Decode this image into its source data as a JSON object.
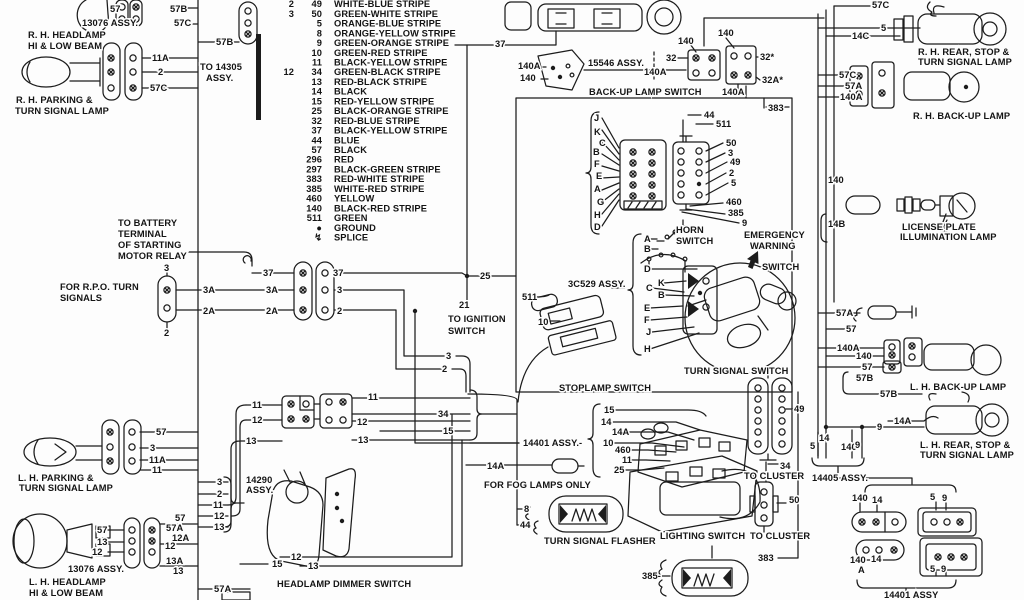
{
  "page": {
    "background": "#fdfdfd",
    "ink": "#1c1c1c"
  },
  "legend": {
    "rows": [
      {
        "a": "2",
        "b": "49",
        "name": "WHITE-BLUE STRIPE"
      },
      {
        "a": "3",
        "b": "50",
        "name": "GREEN-WHITE STRIPE"
      },
      {
        "b": "5",
        "name": "ORANGE-BLUE STRIPE"
      },
      {
        "b": "8",
        "name": "ORANGE-YELLOW STRIPE"
      },
      {
        "b": "9",
        "name": "GREEN-ORANGE STRIPE"
      },
      {
        "b": "10",
        "name": "GREEN-RED STRIPE"
      },
      {
        "b": "11",
        "name": "BLACK-YELLOW STRIPE"
      },
      {
        "a": "12",
        "b": "34",
        "name": "GREEN-BLACK STRIPE"
      },
      {
        "b": "13",
        "name": "RED-BLACK STRIPE"
      },
      {
        "b": "14",
        "name": "BLACK"
      },
      {
        "b": "15",
        "name": "RED-YELLOW STRIPE"
      },
      {
        "b": "25",
        "name": "BLACK-ORANGE STRIPE"
      },
      {
        "b": "32",
        "name": "RED-BLUE STRIPE"
      },
      {
        "b": "37",
        "name": "BLACK-YELLOW STRIPE"
      },
      {
        "b": "44",
        "name": "BLUE"
      },
      {
        "b": "57",
        "name": "BLACK"
      },
      {
        "b": "296",
        "name": "RED"
      },
      {
        "b": "297",
        "name": "BLACK-GREEN STRIPE"
      },
      {
        "b": "383",
        "name": "RED-WHITE STRIPE"
      },
      {
        "b": "385",
        "name": "WHITE-RED STRIPE"
      },
      {
        "b": "460",
        "name": "YELLOW"
      },
      {
        "b": "140",
        "name": "BLACK-RED STRIPE"
      },
      {
        "b": "511",
        "name": "GREEN"
      },
      {
        "b": "●",
        "name": "GROUND"
      },
      {
        "b": "↯",
        "name": "SPLICE"
      }
    ]
  },
  "labels": [
    {
      "t": "57",
      "x": 110,
      "y": 12
    },
    {
      "t": "13076 ASSY.",
      "x": 82,
      "y": 26,
      "n": "assembly-label"
    },
    {
      "t": "57B",
      "x": 170,
      "y": 12
    },
    {
      "t": "57C",
      "x": 174,
      "y": 26
    },
    {
      "t": "R. H. HEADLAMP",
      "x": 28,
      "y": 38,
      "n": "component-label"
    },
    {
      "t": "HI & LOW BEAM",
      "x": 28,
      "y": 49,
      "n": "component-label"
    },
    {
      "t": "57B",
      "x": 216,
      "y": 45
    },
    {
      "t": "TO 14305",
      "x": 200,
      "y": 70,
      "n": "note-label"
    },
    {
      "t": "ASSY.",
      "x": 206,
      "y": 81,
      "n": "note-label"
    },
    {
      "t": "11A",
      "x": 152,
      "y": 61
    },
    {
      "t": "2",
      "x": 158,
      "y": 75
    },
    {
      "t": "57C",
      "x": 150,
      "y": 91
    },
    {
      "t": "R. H. PARKING &",
      "x": 16,
      "y": 103,
      "n": "component-label"
    },
    {
      "t": "TURN SIGNAL LAMP",
      "x": 15,
      "y": 114,
      "n": "component-label"
    },
    {
      "t": "TO BATTERY",
      "x": 118,
      "y": 226,
      "n": "note-label"
    },
    {
      "t": "TERMINAL",
      "x": 118,
      "y": 237,
      "n": "note-label"
    },
    {
      "t": "OF STARTING",
      "x": 118,
      "y": 248,
      "n": "note-label"
    },
    {
      "t": "MOTOR RELAY",
      "x": 118,
      "y": 259,
      "n": "note-label"
    },
    {
      "t": "3",
      "x": 164,
      "y": 271
    },
    {
      "t": "FOR R.P.O. TURN",
      "x": 60,
      "y": 290,
      "n": "note-label"
    },
    {
      "t": "SIGNALS",
      "x": 60,
      "y": 301,
      "n": "note-label"
    },
    {
      "t": "2",
      "x": 164,
      "y": 336
    },
    {
      "t": "37",
      "x": 263,
      "y": 276
    },
    {
      "t": "3A",
      "x": 203,
      "y": 293
    },
    {
      "t": "2A",
      "x": 203,
      "y": 314
    },
    {
      "t": "37",
      "x": 333,
      "y": 276
    },
    {
      "t": "3A",
      "x": 266,
      "y": 293
    },
    {
      "t": "2A",
      "x": 266,
      "y": 314
    },
    {
      "t": "3",
      "x": 337,
      "y": 293
    },
    {
      "t": "2",
      "x": 337,
      "y": 314
    },
    {
      "t": "25",
      "x": 480,
      "y": 279
    },
    {
      "t": "21",
      "x": 459,
      "y": 308
    },
    {
      "t": "TO IGNITION",
      "x": 448,
      "y": 322,
      "n": "note-label"
    },
    {
      "t": "SWITCH",
      "x": 448,
      "y": 334,
      "n": "note-label"
    },
    {
      "t": "3",
      "x": 446,
      "y": 359
    },
    {
      "t": "2",
      "x": 442,
      "y": 372
    },
    {
      "t": "511",
      "x": 522,
      "y": 300
    },
    {
      "t": "10",
      "x": 538,
      "y": 325
    },
    {
      "t": "3C529 ASSY.",
      "x": 568,
      "y": 287,
      "n": "assembly-label"
    },
    {
      "t": "STOPLAMP SWITCH",
      "x": 559,
      "y": 391,
      "n": "component-label"
    },
    {
      "t": "J",
      "x": 594,
      "y": 121
    },
    {
      "t": "K",
      "x": 594,
      "y": 135
    },
    {
      "t": "C",
      "x": 599,
      "y": 146
    },
    {
      "t": "B",
      "x": 593,
      "y": 155
    },
    {
      "t": "F",
      "x": 594,
      "y": 167
    },
    {
      "t": "E",
      "x": 596,
      "y": 179
    },
    {
      "t": "A",
      "x": 594,
      "y": 192
    },
    {
      "t": "G",
      "x": 597,
      "y": 205
    },
    {
      "t": "H",
      "x": 594,
      "y": 218
    },
    {
      "t": "D",
      "x": 594,
      "y": 230
    },
    {
      "t": "44",
      "x": 704,
      "y": 118
    },
    {
      "t": "511",
      "x": 716,
      "y": 127
    },
    {
      "t": "50",
      "x": 726,
      "y": 146
    },
    {
      "t": "3",
      "x": 728,
      "y": 156
    },
    {
      "t": "49",
      "x": 730,
      "y": 165
    },
    {
      "t": "2",
      "x": 729,
      "y": 176
    },
    {
      "t": "5",
      "x": 731,
      "y": 186
    },
    {
      "t": "460",
      "x": 726,
      "y": 205
    },
    {
      "t": "385",
      "x": 728,
      "y": 216
    },
    {
      "t": "9",
      "x": 742,
      "y": 226
    },
    {
      "t": "37",
      "x": 495,
      "y": 47
    },
    {
      "t": "140",
      "x": 678,
      "y": 44
    },
    {
      "t": "140",
      "x": 718,
      "y": 36
    },
    {
      "t": "140A",
      "x": 518,
      "y": 69
    },
    {
      "t": "15546 ASSY.",
      "x": 588,
      "y": 66,
      "n": "assembly-label"
    },
    {
      "t": "140A",
      "x": 644,
      "y": 75
    },
    {
      "t": "32",
      "x": 666,
      "y": 61
    },
    {
      "t": "140",
      "x": 520,
      "y": 81
    },
    {
      "t": "32*",
      "x": 760,
      "y": 60
    },
    {
      "t": "32A*",
      "x": 762,
      "y": 83
    },
    {
      "t": "140A",
      "x": 722,
      "y": 95
    },
    {
      "t": "BACK-UP LAMP SWITCH",
      "x": 589,
      "y": 95,
      "n": "component-label"
    },
    {
      "t": "383",
      "x": 768,
      "y": 111
    },
    {
      "t": "A",
      "x": 644,
      "y": 242
    },
    {
      "t": "B",
      "x": 644,
      "y": 252
    },
    {
      "t": "HORN",
      "x": 676,
      "y": 233,
      "n": "component-label"
    },
    {
      "t": "SWITCH",
      "x": 676,
      "y": 244,
      "n": "component-label"
    },
    {
      "t": "EMERGENCY",
      "x": 744,
      "y": 238,
      "n": "component-label"
    },
    {
      "t": "WARNING",
      "x": 750,
      "y": 249,
      "n": "component-label"
    },
    {
      "t": "SWITCH",
      "x": 762,
      "y": 270,
      "n": "component-label"
    },
    {
      "t": "D",
      "x": 644,
      "y": 272
    },
    {
      "t": "K",
      "x": 658,
      "y": 286
    },
    {
      "t": "C",
      "x": 646,
      "y": 291
    },
    {
      "t": "B",
      "x": 658,
      "y": 298
    },
    {
      "t": "E",
      "x": 644,
      "y": 311
    },
    {
      "t": "F",
      "x": 644,
      "y": 323
    },
    {
      "t": "J",
      "x": 646,
      "y": 335
    },
    {
      "t": "H",
      "x": 644,
      "y": 352
    },
    {
      "t": "TURN SIGNAL SWITCH",
      "x": 684,
      "y": 374,
      "n": "component-label"
    },
    {
      "t": "49",
      "x": 794,
      "y": 412
    },
    {
      "t": "34",
      "x": 780,
      "y": 469
    },
    {
      "t": "TO CLUSTER",
      "x": 744,
      "y": 479,
      "n": "note-label"
    },
    {
      "t": "50",
      "x": 789,
      "y": 503
    },
    {
      "t": "TO CLUSTER",
      "x": 750,
      "y": 539,
      "n": "note-label"
    },
    {
      "t": "383",
      "x": 758,
      "y": 561
    },
    {
      "t": "385-",
      "x": 642,
      "y": 579
    },
    {
      "t": "57C",
      "x": 872,
      "y": 8
    },
    {
      "t": "5",
      "x": 881,
      "y": 31
    },
    {
      "t": "14C",
      "x": 852,
      "y": 39
    },
    {
      "t": "R. H. REAR, STOP &",
      "x": 918,
      "y": 55,
      "n": "component-label"
    },
    {
      "t": "TURN SIGNAL LAMP",
      "x": 918,
      "y": 65,
      "n": "component-label"
    },
    {
      "t": "57C",
      "x": 839,
      "y": 78
    },
    {
      "t": "57A",
      "x": 845,
      "y": 89
    },
    {
      "t": "140A",
      "x": 840,
      "y": 100
    },
    {
      "t": "R. H. BACK-UP LAMP",
      "x": 913,
      "y": 119,
      "n": "component-label"
    },
    {
      "t": "140",
      "x": 828,
      "y": 183
    },
    {
      "t": "14B",
      "x": 828,
      "y": 227
    },
    {
      "t": "LICENSE PLATE",
      "x": 902,
      "y": 230,
      "n": "component-label"
    },
    {
      "t": "ILLUMINATION LAMP",
      "x": 900,
      "y": 240,
      "n": "component-label"
    },
    {
      "t": "57A",
      "x": 836,
      "y": 316
    },
    {
      "t": "57",
      "x": 846,
      "y": 332
    },
    {
      "t": "140A",
      "x": 837,
      "y": 351
    },
    {
      "t": "140",
      "x": 856,
      "y": 359
    },
    {
      "t": "57",
      "x": 862,
      "y": 370
    },
    {
      "t": "57B",
      "x": 856,
      "y": 381
    },
    {
      "t": "57B",
      "x": 880,
      "y": 397
    },
    {
      "t": "L. H. BACK-UP LAMP",
      "x": 910,
      "y": 390,
      "n": "component-label"
    },
    {
      "t": "9",
      "x": 877,
      "y": 430
    },
    {
      "t": "14A",
      "x": 894,
      "y": 424
    },
    {
      "t": "L. H. REAR, STOP &",
      "x": 920,
      "y": 448,
      "n": "component-label"
    },
    {
      "t": "TURN SIGNAL LAMP",
      "x": 920,
      "y": 458,
      "n": "component-label"
    },
    {
      "t": "14",
      "x": 819,
      "y": 441
    },
    {
      "t": "5",
      "x": 810,
      "y": 449
    },
    {
      "t": "140",
      "x": 841,
      "y": 450
    },
    {
      "t": "9",
      "x": 855,
      "y": 448
    },
    {
      "t": "14405 ASSY.",
      "x": 812,
      "y": 481,
      "n": "assembly-label"
    },
    {
      "t": "140",
      "x": 852,
      "y": 501
    },
    {
      "t": "14",
      "x": 872,
      "y": 503
    },
    {
      "t": "5",
      "x": 930,
      "y": 500
    },
    {
      "t": "9",
      "x": 942,
      "y": 501
    },
    {
      "t": "140",
      "x": 850,
      "y": 563
    },
    {
      "t": "A",
      "x": 858,
      "y": 573
    },
    {
      "t": "14",
      "x": 871,
      "y": 562
    },
    {
      "t": "5",
      "x": 930,
      "y": 572
    },
    {
      "t": "9",
      "x": 941,
      "y": 572
    },
    {
      "t": "14401 ASSY",
      "x": 884,
      "y": 598,
      "n": "assembly-label"
    },
    {
      "t": "15",
      "x": 604,
      "y": 413
    },
    {
      "t": "14",
      "x": 601,
      "y": 425
    },
    {
      "t": "14A",
      "x": 612,
      "y": 435
    },
    {
      "t": "10",
      "x": 603,
      "y": 446
    },
    {
      "t": "460",
      "x": 615,
      "y": 453
    },
    {
      "t": "11",
      "x": 622,
      "y": 463
    },
    {
      "t": "25",
      "x": 614,
      "y": 473
    },
    {
      "t": "14401 ASSY.-",
      "x": 523,
      "y": 446,
      "n": "assembly-label"
    },
    {
      "t": "14A",
      "x": 487,
      "y": 469
    },
    {
      "t": "FOR FOG LAMPS ONLY",
      "x": 484,
      "y": 488,
      "n": "note-label"
    },
    {
      "t": "8",
      "x": 524,
      "y": 512
    },
    {
      "t": "44",
      "x": 520,
      "y": 528
    },
    {
      "t": "TURN SIGNAL FLASHER",
      "x": 544,
      "y": 544,
      "n": "component-label"
    },
    {
      "t": "LIGHTING SWITCH",
      "x": 660,
      "y": 539,
      "n": "component-label"
    },
    {
      "t": "57",
      "x": 156,
      "y": 435
    },
    {
      "t": "3",
      "x": 150,
      "y": 451
    },
    {
      "t": "11A",
      "x": 149,
      "y": 463
    },
    {
      "t": "11",
      "x": 152,
      "y": 473
    },
    {
      "t": "L. H. PARKING &",
      "x": 18,
      "y": 481,
      "n": "component-label"
    },
    {
      "t": "TURN SIGNAL LAMP",
      "x": 19,
      "y": 491,
      "n": "component-label"
    },
    {
      "t": "3",
      "x": 217,
      "y": 485
    },
    {
      "t": "2",
      "x": 217,
      "y": 497
    },
    {
      "t": "11",
      "x": 213,
      "y": 508
    },
    {
      "t": "12",
      "x": 214,
      "y": 519
    },
    {
      "t": "13",
      "x": 214,
      "y": 530
    },
    {
      "t": "14290",
      "x": 246,
      "y": 483,
      "n": "assembly-label"
    },
    {
      "t": "ASSY.",
      "x": 246,
      "y": 493,
      "n": "assembly-label"
    },
    {
      "t": "57",
      "x": 97,
      "y": 533
    },
    {
      "t": "13",
      "x": 97,
      "y": 545
    },
    {
      "t": "12",
      "x": 92,
      "y": 555
    },
    {
      "t": "57",
      "x": 175,
      "y": 521
    },
    {
      "t": "57A",
      "x": 166,
      "y": 531
    },
    {
      "t": "12A",
      "x": 172,
      "y": 541
    },
    {
      "t": "12",
      "x": 165,
      "y": 549
    },
    {
      "t": "13A",
      "x": 166,
      "y": 564
    },
    {
      "t": "13",
      "x": 173,
      "y": 574
    },
    {
      "t": "13076 ASSY.",
      "x": 68,
      "y": 572,
      "n": "assembly-label"
    },
    {
      "t": "L. H. HEADLAMP",
      "x": 29,
      "y": 585,
      "n": "component-label"
    },
    {
      "t": "HI & LOW BEAM",
      "x": 29,
      "y": 596,
      "n": "component-label"
    },
    {
      "t": "57A",
      "x": 214,
      "y": 592
    },
    {
      "t": "11",
      "x": 252,
      "y": 408
    },
    {
      "t": "12",
      "x": 252,
      "y": 423
    },
    {
      "t": "13",
      "x": 246,
      "y": 444
    },
    {
      "t": "11",
      "x": 368,
      "y": 400
    },
    {
      "t": "34",
      "x": 438,
      "y": 417
    },
    {
      "t": "12",
      "x": 357,
      "y": 425
    },
    {
      "t": "13",
      "x": 358,
      "y": 443
    },
    {
      "t": "15",
      "x": 443,
      "y": 434
    },
    {
      "t": "12",
      "x": 291,
      "y": 560
    },
    {
      "t": "15",
      "x": 272,
      "y": 567
    },
    {
      "t": "13",
      "x": 308,
      "y": 569
    },
    {
      "t": "HEADLAMP DIMMER SWITCH",
      "x": 277,
      "y": 587,
      "n": "component-label"
    }
  ]
}
